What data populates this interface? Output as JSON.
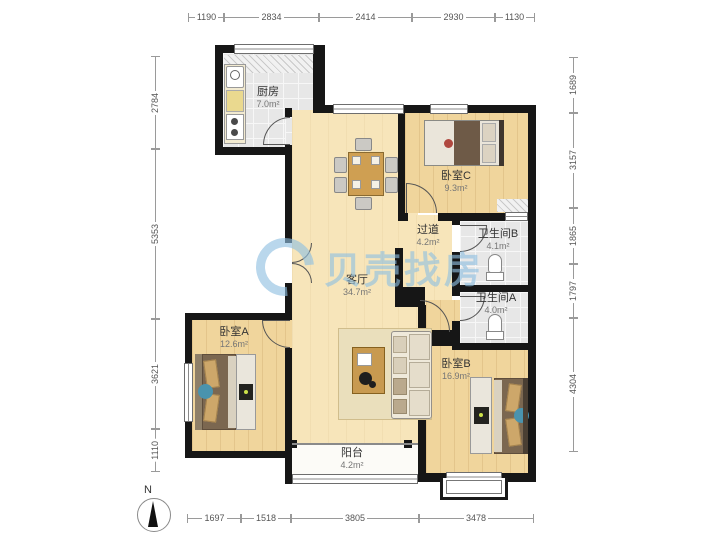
{
  "watermark": {
    "brand_text": "贝壳找房",
    "color": "#8fc0e2"
  },
  "compass": {
    "north_label": "N"
  },
  "dimensions_mm": {
    "top": [
      "1190",
      "2834",
      "2414",
      "2930",
      "1130"
    ],
    "left": [
      "2784",
      "5353",
      "3621",
      "1110"
    ],
    "right": [
      "1689",
      "3157",
      "1865",
      "1797",
      "4304"
    ],
    "bottom": [
      "1697",
      "1518",
      "3805",
      "3478"
    ]
  },
  "rooms": {
    "kitchen": {
      "name": "厨房",
      "area": "7.0m²"
    },
    "bedroom_c": {
      "name": "卧室C",
      "area": "9.3m²"
    },
    "hallway": {
      "name": "过道",
      "area": "4.2m²"
    },
    "bathroom_b": {
      "name": "卫生间B",
      "area": "4.1m²"
    },
    "bathroom_a": {
      "name": "卫生间A",
      "area": "4.0m²"
    },
    "living_room": {
      "name": "客厅",
      "area": "34.7m²"
    },
    "bedroom_a": {
      "name": "卧室A",
      "area": "12.6m²"
    },
    "bedroom_b": {
      "name": "卧室B",
      "area": "16.9m²"
    },
    "balcony": {
      "name": "阳台",
      "area": "4.2m²"
    }
  },
  "colors": {
    "wall": "#161616",
    "wood_floor": "#f0d59c",
    "living_floor": "#f7e5ba",
    "tile_floor": "#e7e7e7",
    "watermark_blue": "#8fc0e2",
    "decor_blue": "#4a93ad"
  }
}
